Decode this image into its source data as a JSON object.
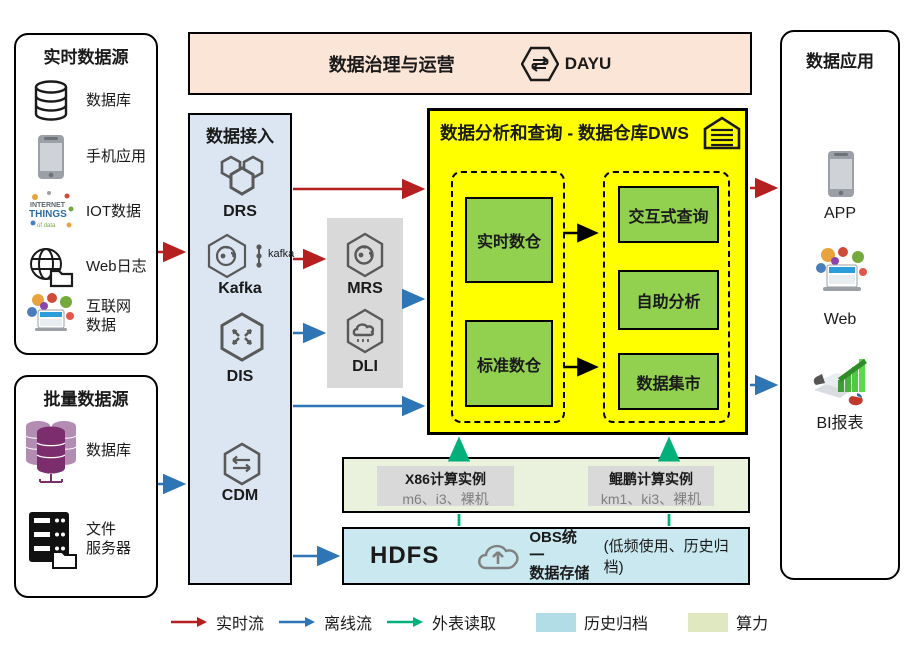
{
  "colors": {
    "realtime_flow": "#b41f1f",
    "offline_flow": "#2e75b6",
    "foreign_read": "#00b07a",
    "archive_fill": "#b3dde6",
    "compute_fill": "#dfe8c0",
    "dws_bg": "#ffff00",
    "dws_node": "#92d050",
    "ingest_bg": "#dce6f2",
    "banner_bg": "#fbe5d6",
    "gray_bg": "#d9d9d9"
  },
  "realtime_sources": {
    "title": "实时数据源",
    "items": [
      {
        "icon": "database-icon",
        "label": "数据库"
      },
      {
        "icon": "mobile-phone-icon",
        "label": "手机应用"
      },
      {
        "icon": "iot-wordcloud-icon",
        "label": "IOT数据"
      },
      {
        "icon": "web-log-icon",
        "label": "Web日志"
      },
      {
        "icon": "internet-collage-icon",
        "label": "互联网\n数据"
      }
    ]
  },
  "batch_sources": {
    "title": "批量数据源",
    "items": [
      {
        "icon": "purple-database-icon",
        "label": "数据库"
      },
      {
        "icon": "file-server-icon",
        "label": "文件\n服务器"
      }
    ]
  },
  "governance": {
    "title": "数据治理与运营",
    "product": "DAYU"
  },
  "ingestion": {
    "title": "数据接入",
    "items": [
      {
        "icon": "drs-hexagon-icon",
        "label": "DRS"
      },
      {
        "icon": "kafka-hexagon-icon",
        "label": "Kafka",
        "logo_text": "kafka"
      },
      {
        "icon": "dis-hexagon-icon",
        "label": "DIS"
      },
      {
        "icon": "cdm-hexagon-icon",
        "label": "CDM"
      }
    ]
  },
  "processing": {
    "items": [
      {
        "icon": "mrs-hexagon-icon",
        "label": "MRS"
      },
      {
        "icon": "dli-hexagon-icon",
        "label": "DLI"
      }
    ]
  },
  "dws": {
    "title": "数据分析和查询 - 数据仓库DWS",
    "left_group": [
      "实时数仓",
      "标准数仓"
    ],
    "right_group": [
      "交互式查询",
      "自助分析",
      "数据集市"
    ]
  },
  "compute": {
    "instances": [
      {
        "title": "X86计算实例",
        "subtitle": "m6、i3、裸机"
      },
      {
        "title": "鲲鹏计算实例",
        "subtitle": "km1、ki3、裸机"
      }
    ]
  },
  "storage": {
    "hdfs": "HDFS",
    "obs": "OBS统一\n数据存储",
    "note": "(低频使用、历史归档)"
  },
  "applications": {
    "title": "数据应用",
    "items": [
      {
        "icon": "app-phone-icon",
        "label": "APP"
      },
      {
        "icon": "web-collage-icon",
        "label": "Web"
      },
      {
        "icon": "bi-report-icon",
        "label": "BI报表"
      }
    ]
  },
  "legend": {
    "items": [
      {
        "kind": "arrow",
        "color": "#b41f1f",
        "label": "实时流"
      },
      {
        "kind": "arrow",
        "color": "#2e75b6",
        "label": "离线流"
      },
      {
        "kind": "arrow",
        "color": "#00b07a",
        "label": "外表读取"
      },
      {
        "kind": "swatch",
        "color": "#b3dde6",
        "label": "历史归档"
      },
      {
        "kind": "swatch",
        "color": "#dfe8c0",
        "label": "算力"
      }
    ]
  }
}
